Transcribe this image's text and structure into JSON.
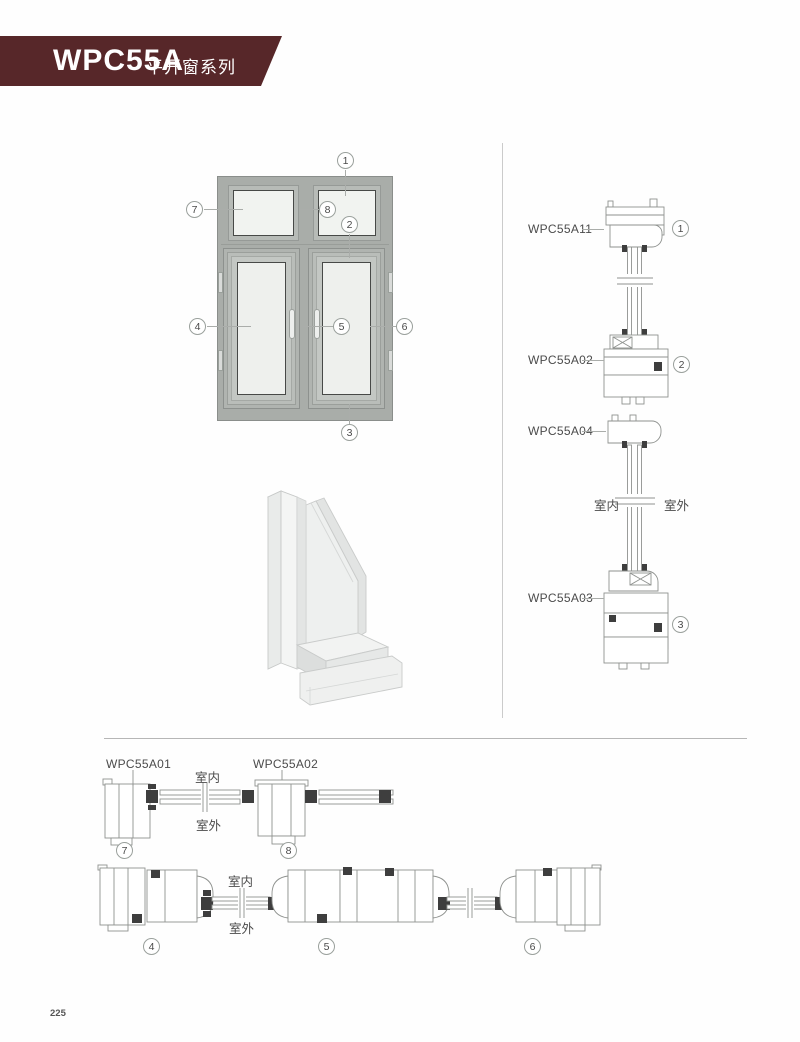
{
  "header": {
    "series_code": "WPC55A",
    "series_name": "平开窗系列",
    "banner_color": "#572729"
  },
  "front_view": {
    "callouts": [
      "1",
      "2",
      "3",
      "4",
      "5",
      "6",
      "7",
      "8"
    ]
  },
  "vertical_section": {
    "profiles": [
      {
        "label": "WPC55A11",
        "callout": "1"
      },
      {
        "label": "WPC55A02",
        "callout": "2"
      },
      {
        "label": "WPC55A04",
        "callout": ""
      },
      {
        "label": "WPC55A03",
        "callout": "3"
      }
    ],
    "indoor": "室内",
    "outdoor": "室外"
  },
  "top_horizontal_section": {
    "labels": [
      "WPC55A01",
      "WPC55A02"
    ],
    "indoor": "室内",
    "outdoor": "室外",
    "callouts": [
      "7",
      "8"
    ]
  },
  "bottom_horizontal_section": {
    "indoor": "室内",
    "outdoor": "室外",
    "callouts": [
      "4",
      "5",
      "6"
    ]
  },
  "footer": {
    "page_number": "225"
  }
}
